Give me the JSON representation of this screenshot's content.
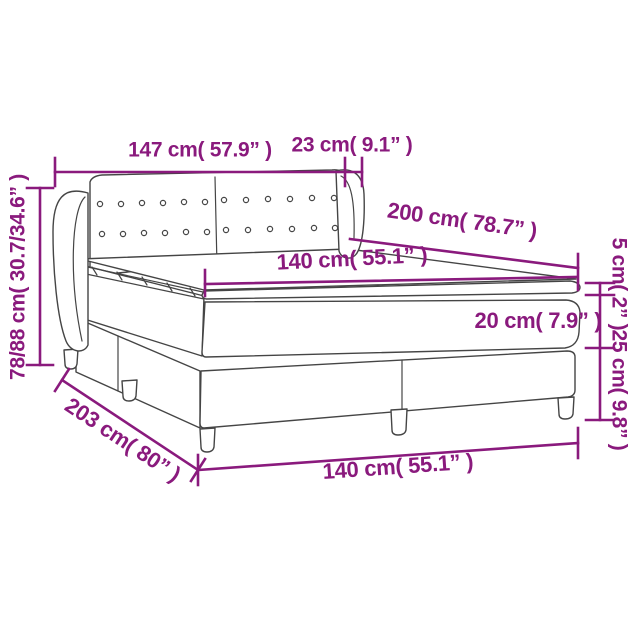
{
  "diagram": {
    "kind": "product-dimension-diagram",
    "product": "box spring bed with tufted winged headboard, mattress and topper",
    "colors": {
      "accent": "#8a1a7d",
      "line": "#454545",
      "background": "#ffffff"
    },
    "labels": {
      "headboard_width": "147 cm( 57.9” )",
      "wing_depth": "23 cm( 9.1” )",
      "total_height": "78/88 cm( 30.7/34.6” )",
      "bed_length": "200 cm( 78.7” )",
      "mattress_width": "140 cm( 55.1” )",
      "topper_height": "5 cm( 2” )",
      "mattress_height": "20 cm( 7.9” )",
      "base_height": "25 cm( 9.8” )",
      "total_length": "203 cm( 80” )",
      "base_width": "140 cm( 55.1” )"
    },
    "measurements": [
      {
        "name": "headboard width",
        "cm": "147",
        "inches": "57.9"
      },
      {
        "name": "headboard wing depth",
        "cm": "23",
        "inches": "9.1"
      },
      {
        "name": "total height range",
        "cm": "78/88",
        "inches": "30.7/34.6"
      },
      {
        "name": "mattress length",
        "cm": "200",
        "inches": "78.7"
      },
      {
        "name": "mattress width",
        "cm": "140",
        "inches": "55.1"
      },
      {
        "name": "topper thickness",
        "cm": "5",
        "inches": "2"
      },
      {
        "name": "mattress thickness",
        "cm": "20",
        "inches": "7.9"
      },
      {
        "name": "base height",
        "cm": "25",
        "inches": "9.8"
      },
      {
        "name": "total length",
        "cm": "203",
        "inches": "80"
      },
      {
        "name": "base width",
        "cm": "140",
        "inches": "55.1"
      }
    ]
  }
}
